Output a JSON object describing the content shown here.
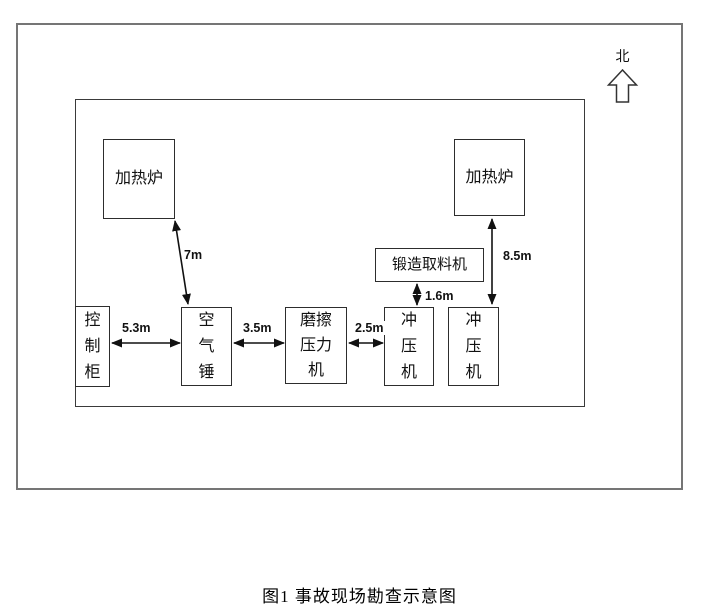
{
  "compass": {
    "north_label": "北"
  },
  "equipment": {
    "furnace_left": "加热炉",
    "furnace_right": "加热炉",
    "reclaimer": "锻造取料机",
    "control_cabinet": "控制柜",
    "air_hammer": "空气锤",
    "friction_press": "磨擦压力机",
    "punch_press_1": "冲压机",
    "punch_press_2": "冲压机"
  },
  "dimensions": {
    "furnace_to_air_hammer": "7m",
    "cabinet_to_air_hammer": "5.3m",
    "air_hammer_to_friction_press": "3.5m",
    "friction_press_to_punch_press": "2.5m",
    "reclaimer_to_punch_press": "1.6m",
    "furnace_to_punch_press": "8.5m"
  },
  "caption": "图1 事故现场勘查示意图"
}
